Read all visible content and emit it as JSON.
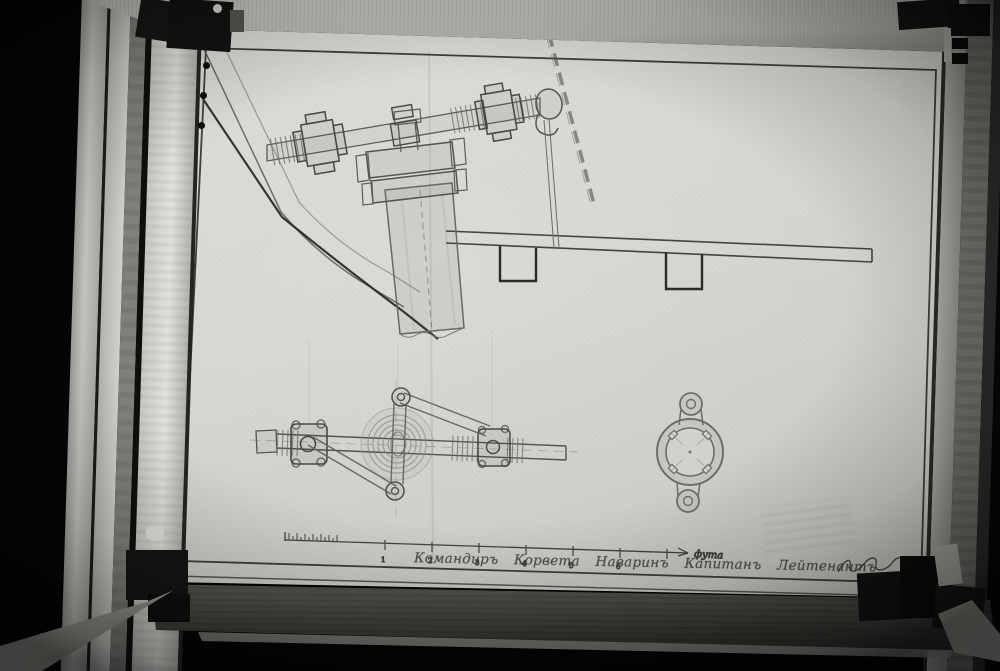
{
  "drawing": {
    "caption_text": "Командиръ Корвета Наваринъ Капитанъ Лейтенантъ",
    "scale_bar": {
      "tick_labels": [
        "1",
        "2",
        "3",
        "4",
        "5",
        "6"
      ],
      "unit_label": "фута"
    }
  },
  "colors": {
    "photo_background": "#050505",
    "paper": "#d6d6d2",
    "pencil_ink": "#3f3f3a",
    "dark_ink": "#2b2b27",
    "frame_wood_light": "#c4c4c0",
    "frame_wood_dark": "#70706c",
    "hardware_metal": "#121210"
  }
}
